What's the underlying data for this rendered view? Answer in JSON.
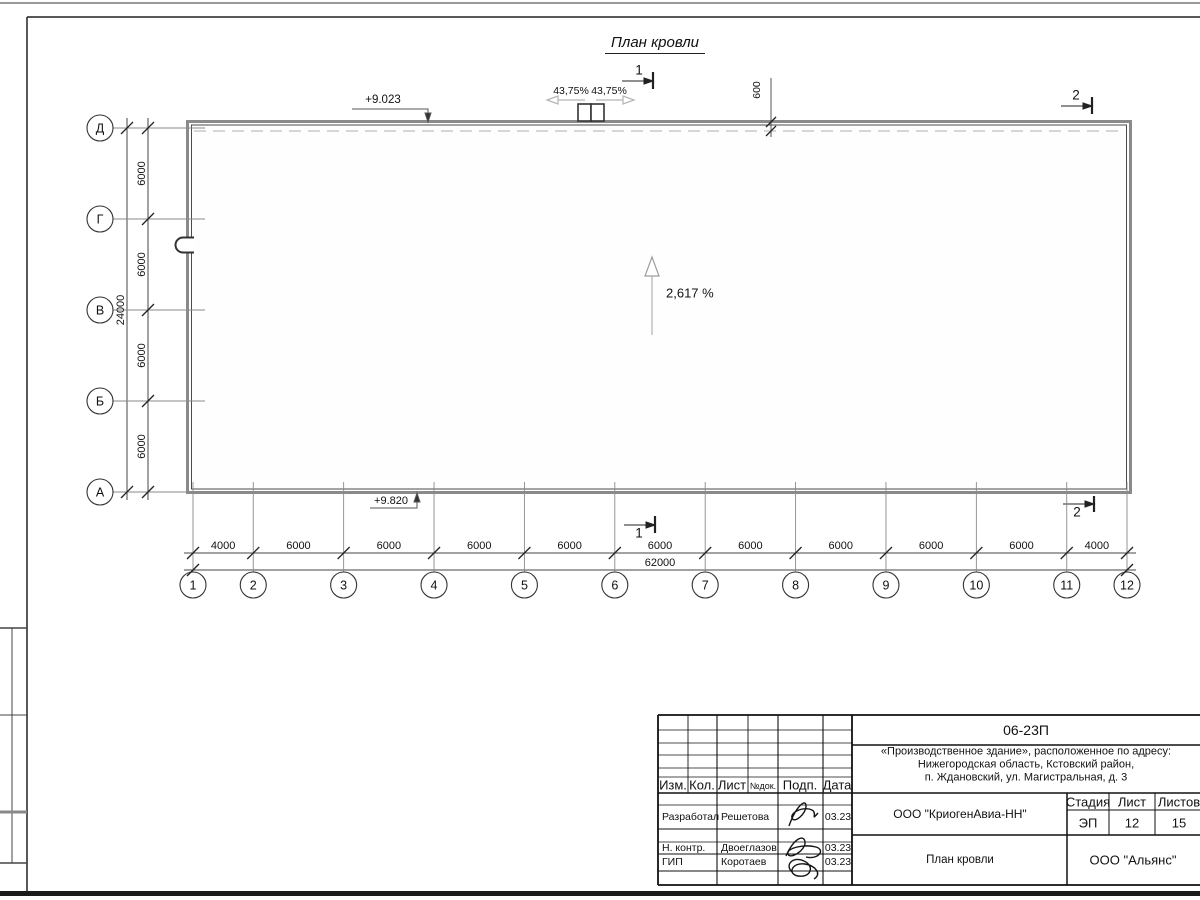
{
  "page": {
    "background": "#ffffff",
    "line_color": "#333333"
  },
  "drawing": {
    "title": "План кровли",
    "elevations": {
      "top": "+9.023",
      "bottom": "+9.820"
    },
    "slopes": {
      "main": "2,617 %",
      "left": "43,75%",
      "right": "43,75%"
    },
    "parapet_width": "600",
    "section_marks": {
      "one": "1",
      "two": "2"
    },
    "grid": {
      "col_labels": [
        "1",
        "2",
        "3",
        "4",
        "5",
        "6",
        "7",
        "8",
        "9",
        "10",
        "11",
        "12"
      ],
      "col_dims": [
        "4000",
        "6000",
        "6000",
        "6000",
        "6000",
        "6000",
        "6000",
        "6000",
        "6000",
        "6000",
        "4000"
      ],
      "total_width": "62000",
      "row_labels": [
        "Д",
        "Г",
        "В",
        "Б",
        "А"
      ],
      "row_dims": [
        "6000",
        "6000",
        "6000",
        "6000"
      ],
      "total_height": "24000"
    }
  },
  "title_block": {
    "code": "06-23П",
    "project_lines": [
      "«Производственное здание», расположенное по адресу:",
      "Нижегородская область, Кстовский район,",
      "п. Ждановский, ул. Магистральная, д. 3"
    ],
    "client": "ООО \"КриогенАвиа-НН\"",
    "sheet_name": "План кровли",
    "contractor": "ООО \"Альянс\"",
    "stage": {
      "label": "Стадия",
      "value": "ЭП"
    },
    "sheet": {
      "label": "Лист",
      "value": "12"
    },
    "sheets": {
      "label": "Листов",
      "value": "15"
    },
    "header": [
      "Изм.",
      "Кол.",
      "Лист",
      "№док.",
      "Подп.",
      "Дата"
    ],
    "signers": [
      {
        "role": "Разработал",
        "name": "Решетова",
        "date": "03.23"
      },
      {
        "role": "Н. контр.",
        "name": "Двоеглазов",
        "date": "03.23"
      },
      {
        "role": "ГИП",
        "name": "Коротаев",
        "date": "03.23"
      }
    ]
  }
}
